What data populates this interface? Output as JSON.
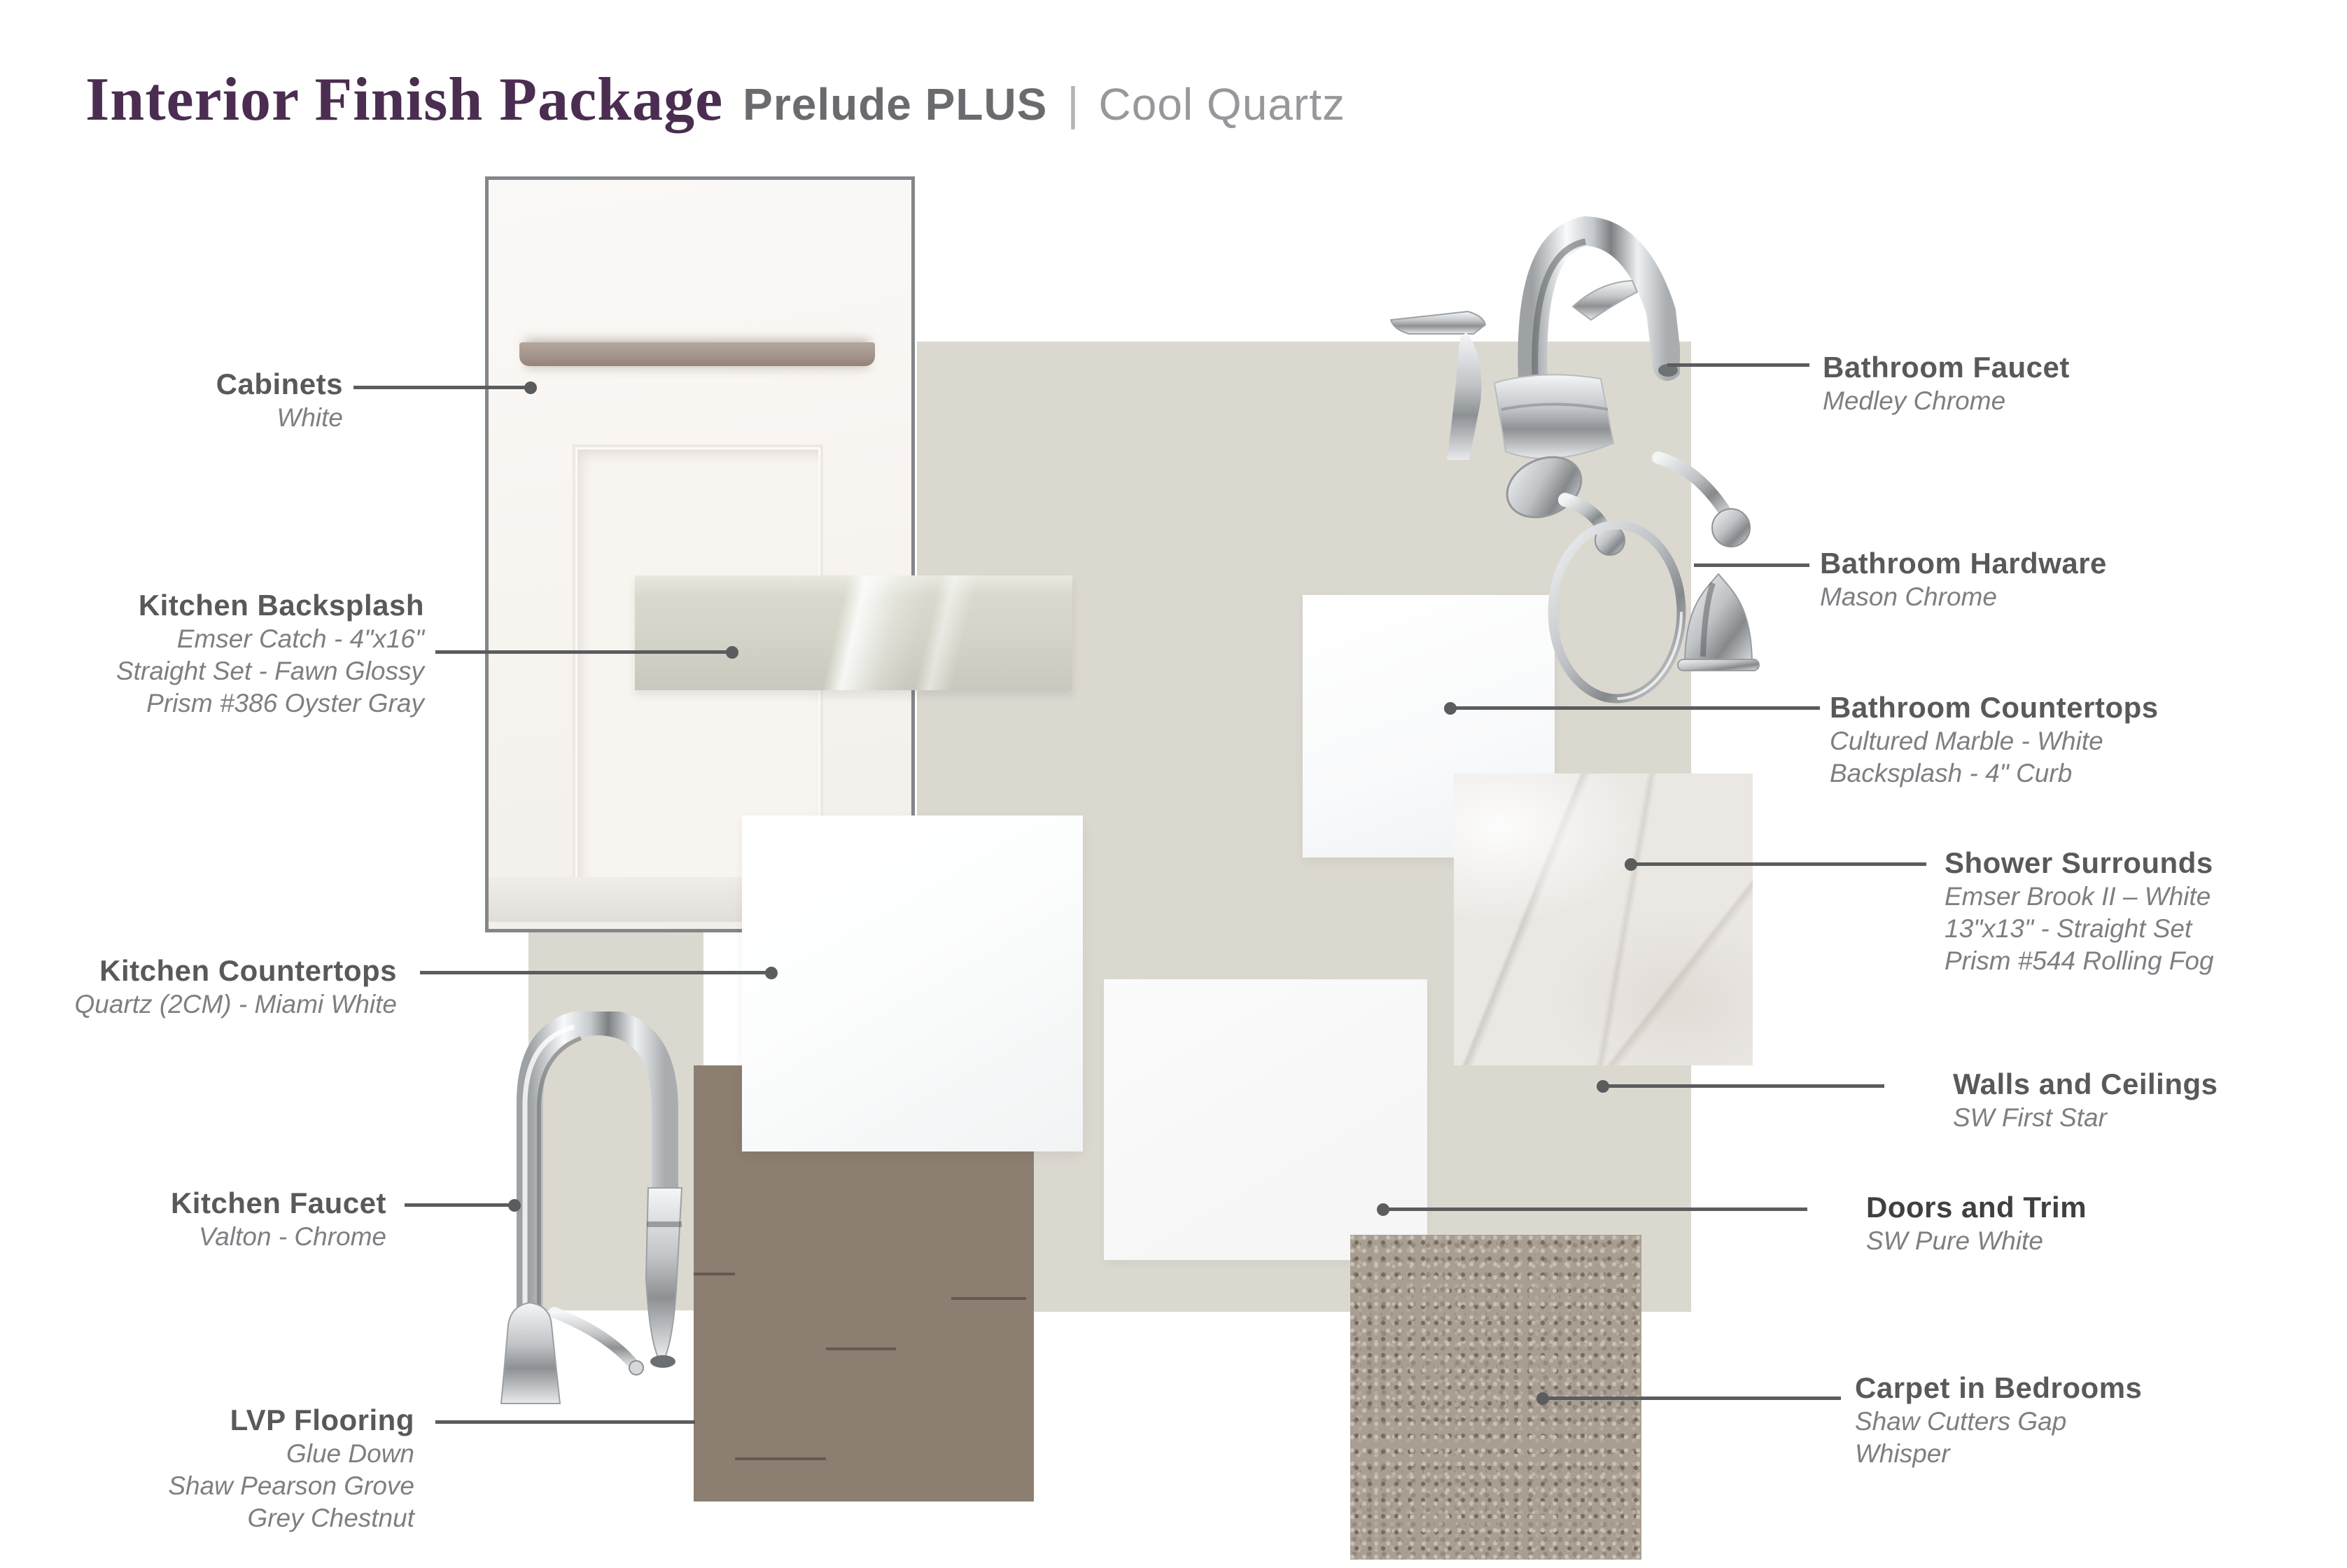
{
  "title": {
    "main": "Interior Finish Package",
    "package": "Prelude PLUS",
    "divider": "|",
    "variant": "Cool Quartz"
  },
  "labels": {
    "cabinets": {
      "heading": "Cabinets",
      "lines": [
        "White"
      ]
    },
    "kitchen_backsplash": {
      "heading": "Kitchen Backsplash",
      "lines": [
        "Emser Catch - 4\"x16\"",
        "Straight Set - Fawn Glossy",
        "Prism #386 Oyster Gray"
      ]
    },
    "kitchen_countertops": {
      "heading": "Kitchen Countertops",
      "lines": [
        "Quartz (2CM) - Miami White"
      ]
    },
    "kitchen_faucet": {
      "heading": "Kitchen Faucet",
      "lines": [
        "Valton - Chrome"
      ]
    },
    "lvp_flooring": {
      "heading": "LVP Flooring",
      "lines": [
        "Glue Down",
        "Shaw Pearson Grove",
        "Grey Chestnut"
      ]
    },
    "bathroom_faucet": {
      "heading": "Bathroom Faucet",
      "lines": [
        "Medley Chrome"
      ]
    },
    "bathroom_hardware": {
      "heading": "Bathroom Hardware",
      "lines": [
        "Mason Chrome"
      ]
    },
    "bathroom_countertops": {
      "heading": "Bathroom Countertops",
      "lines": [
        "Cultured Marble - White",
        "Backsplash - 4\" Curb"
      ]
    },
    "shower_surrounds": {
      "heading": "Shower Surrounds",
      "lines": [
        "Emser Brook II – White",
        "13\"x13\" - Straight Set",
        "Prism #544 Rolling Fog"
      ]
    },
    "walls_ceilings": {
      "heading": "Walls and Ceilings",
      "lines": [
        "SW First Star"
      ]
    },
    "doors_trim": {
      "heading": "Doors and Trim",
      "lines": [
        "SW Pure White"
      ]
    },
    "carpet_bedrooms": {
      "heading": "Carpet in Bedrooms",
      "lines": [
        "Shaw Cutters Gap",
        "Whisper"
      ]
    }
  },
  "colors": {
    "accent_purple": "#4b2d51",
    "heading_gray": "#58595b",
    "subtext_gray": "#7d7f82",
    "leader_gray": "#5b5c5e",
    "wall_beige": "#dbd8d0",
    "wood_brown": "#8c7e71",
    "carpet_taupe": "#a89e92",
    "tile_fawn": "#d3d3c7",
    "chrome": "#c6c9cc"
  }
}
